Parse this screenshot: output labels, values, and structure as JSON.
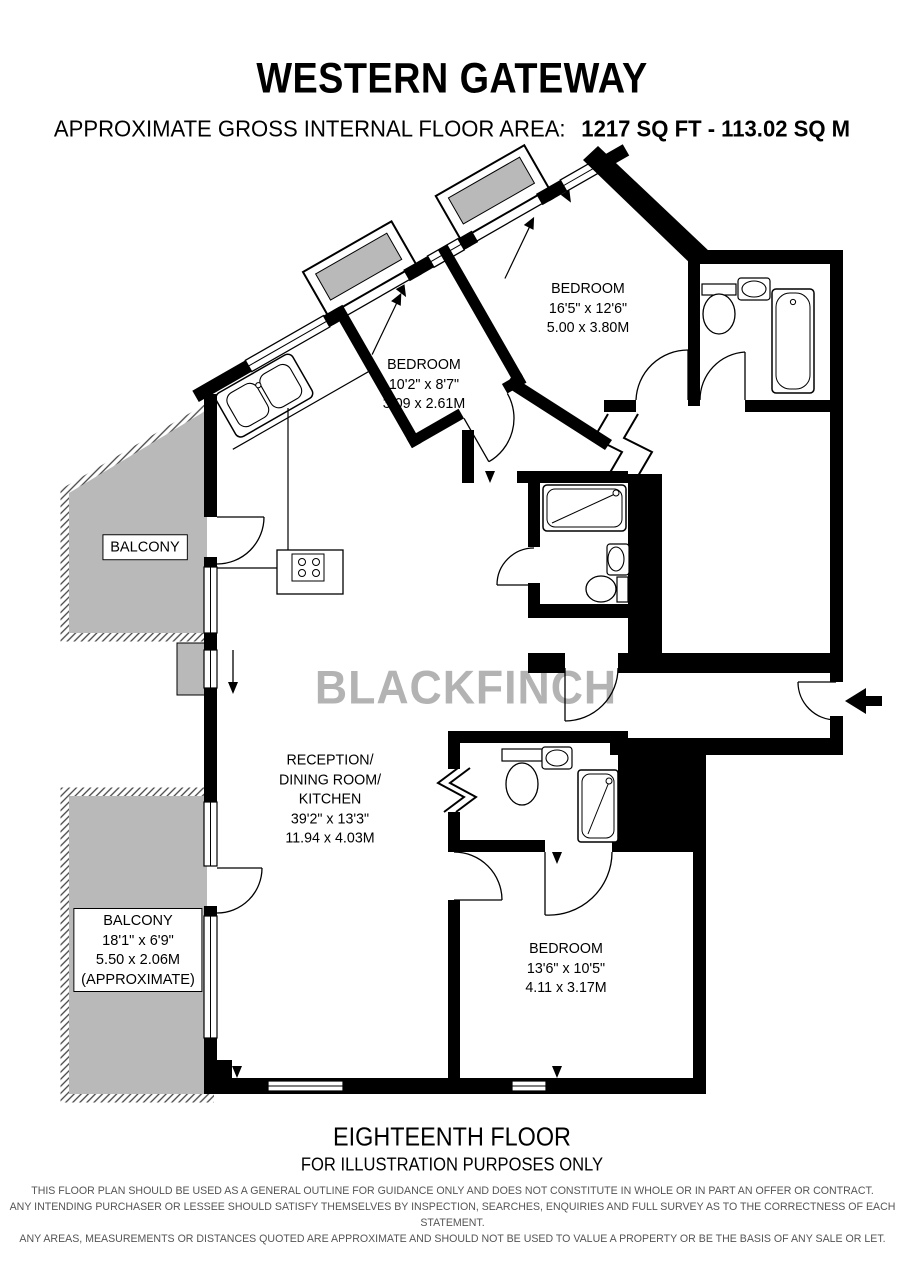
{
  "header": {
    "title": "WESTERN GATEWAY",
    "area_label": "APPROXIMATE GROSS INTERNAL FLOOR AREA:",
    "area_value": "1217 SQ FT - 113.02 SQ M"
  },
  "watermark": "BLACKFINCH",
  "rooms": {
    "bedroom_top_right": {
      "name": "BEDROOM",
      "imperial": "16'5\" x 12'6\"",
      "metric": "5.00 x 3.80M"
    },
    "bedroom_middle": {
      "name": "BEDROOM",
      "imperial": "10'2\" x 8'7\"",
      "metric": "3.09 x 2.61M"
    },
    "bedroom_bottom": {
      "name": "BEDROOM",
      "imperial": "13'6\" x 10'5\"",
      "metric": "4.11 x 3.17M"
    },
    "reception": {
      "line1": "RECEPTION/",
      "line2": "DINING ROOM/",
      "line3": "KITCHEN",
      "imperial": "39'2\" x 13'3\"",
      "metric": "11.94 x 4.03M"
    },
    "balcony_top": {
      "name": "BALCONY"
    },
    "balcony_bottom": {
      "name": "BALCONY",
      "imperial": "18'1\" x 6'9\"",
      "metric": "5.50 x 2.06M",
      "note": "(APPROXIMATE)"
    }
  },
  "footer": {
    "floor": "EIGHTEENTH FLOOR",
    "note": "FOR ILLUSTRATION PURPOSES ONLY",
    "disclaimer": [
      "THIS FLOOR PLAN SHOULD BE USED AS A GENERAL OUTLINE FOR GUIDANCE ONLY AND DOES NOT CONSTITUTE IN WHOLE OR IN PART AN OFFER OR CONTRACT.",
      "ANY INTENDING PURCHASER OR LESSEE SHOULD SATISFY THEMSELVES BY INSPECTION, SEARCHES, ENQUIRIES AND FULL SURVEY AS TO THE CORRECTNESS OF EACH STATEMENT.",
      "ANY AREAS, MEASUREMENTS OR DISTANCES QUOTED ARE APPROXIMATE AND SHOULD NOT BE USED TO VALUE A PROPERTY OR BE THE BASIS OF ANY SALE OR LET."
    ]
  },
  "symbols": {
    "entrance": "arrow-left-icon",
    "balcony_step": "arrow-down-icon"
  },
  "colors": {
    "wall": "#000000",
    "balcony_fill": "#b9b9b9",
    "watermark": "#b3b3b3"
  }
}
